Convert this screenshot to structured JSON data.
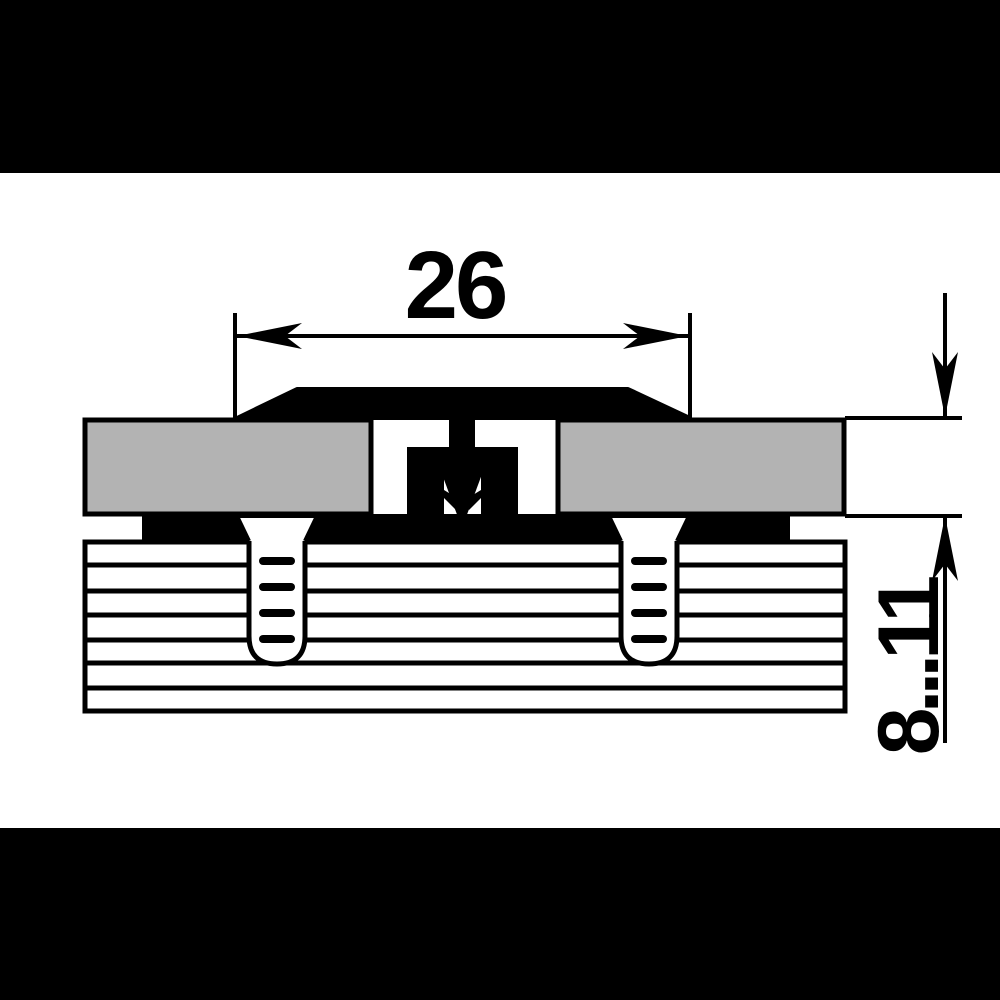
{
  "meta": {
    "description": "Technical cross-section drawing of an aluminium threshold floor profile with snap-in clip, screws into a chipboard base, shown with two dimensions"
  },
  "drawing": {
    "dimensions": {
      "width_label": "26",
      "height_range_label": "8...11"
    },
    "colors": {
      "line": "#000000",
      "panel_fill": "#b3b3b3",
      "background": "#ffffff",
      "letterbox": "#000000"
    }
  }
}
